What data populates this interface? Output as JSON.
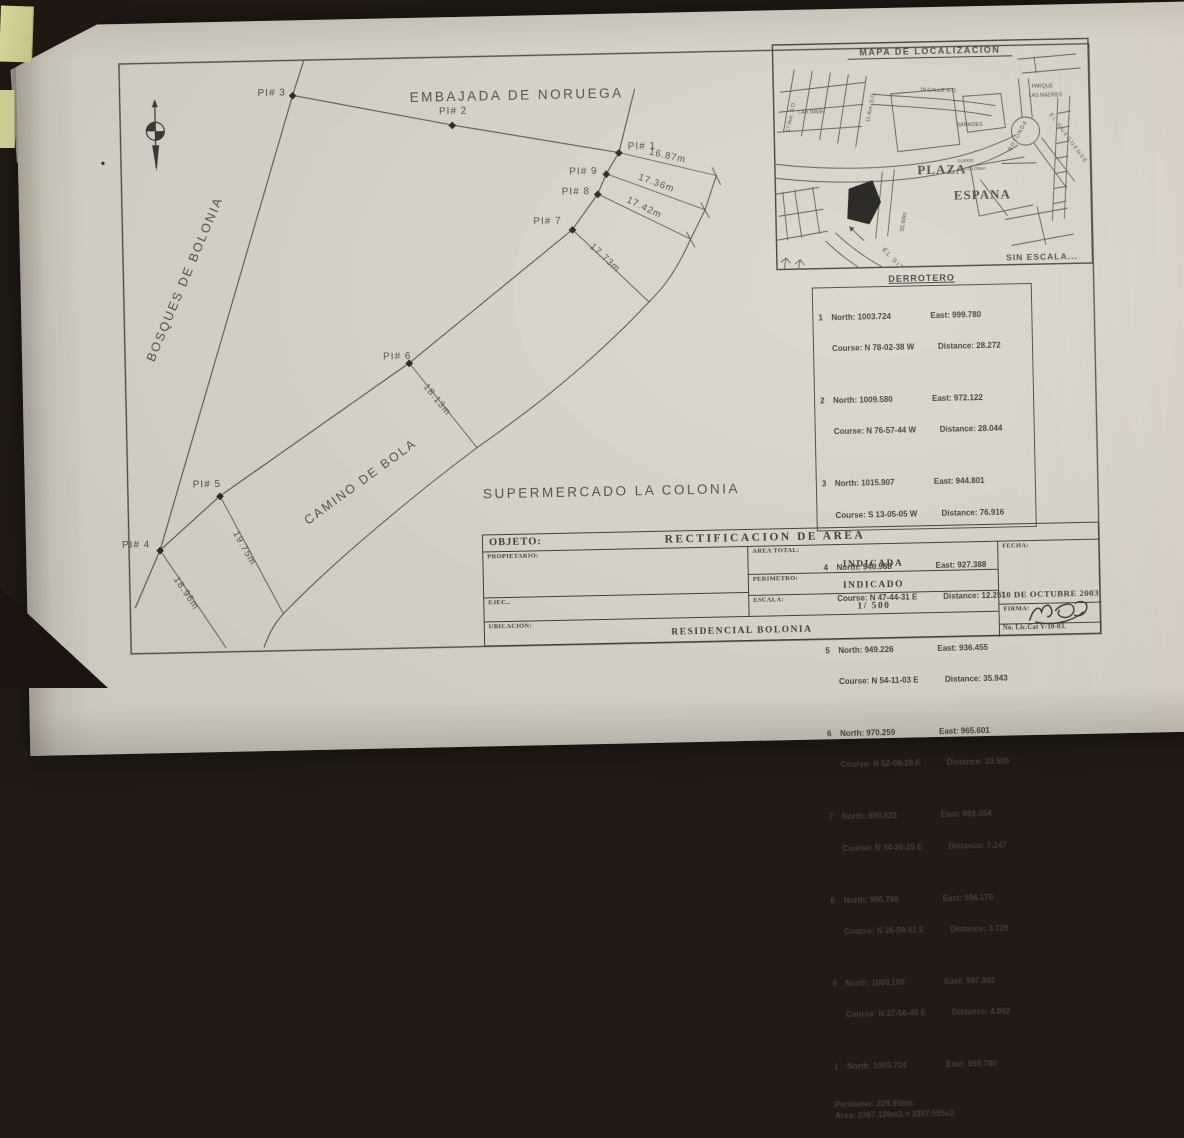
{
  "plan": {
    "embassy": "EMBAJADA DE NORUEGA",
    "bosques": "BOSQUES DE BOLONIA",
    "camino": "CAMINO DE BOLA",
    "supermercado": "SUPERMERCADO LA COLONIA",
    "pi": {
      "p1": "PI# 1",
      "p2": "PI# 2",
      "p3": "PI# 3",
      "p4": "PI# 4",
      "p5": "PI# 5",
      "p6": "PI# 6",
      "p7": "PI# 7",
      "p8": "PI# 8",
      "p9": "PI# 9"
    },
    "dims": {
      "d1": "16.87m",
      "d9": "17.36m",
      "d8": "17.42m",
      "d7": "17.73m",
      "d6": "18.13m",
      "d5": "19.75m",
      "d4": "18.96m"
    }
  },
  "map": {
    "title": "MAPA DE LOCALIZACION",
    "no_scale": "SIN ESCALA...",
    "labels": {
      "ave17": "17 Ave. S.O.",
      "carwash": "CAR WASH",
      "ave11": "11 Ave. S.O.",
      "calle18": "18 CALLE S.O.",
      "banades": "BANADES",
      "parque1": "PARQUE",
      "parque2": "LAS MADRES",
      "rotonda": "ROTONDA",
      "gueguense": "EL GUEGUENSE",
      "plaza": "PLAZA",
      "espana": "ESPANA",
      "super1": "SUPER",
      "super2": "LA COLONIA",
      "dim": "55.60m",
      "sitio": "EL SITIO"
    }
  },
  "derrotero": {
    "title": "DERROTERO",
    "labels": {
      "north": "North:",
      "east": "East:",
      "course": "Course:",
      "distance": "Distance:"
    },
    "rows": [
      {
        "n": "1",
        "north": "1003.724",
        "east": "999.780",
        "course": "N 78-02-38 W",
        "distance": "28.272"
      },
      {
        "n": "2",
        "north": "1009.580",
        "east": "972.122",
        "course": "N 76-57-44 W",
        "distance": "28.044"
      },
      {
        "n": "3",
        "north": "1015.907",
        "east": "944.801",
        "course": "S 13-05-05 W",
        "distance": "76.916"
      },
      {
        "n": "4",
        "north": "940.988",
        "east": "927.388",
        "course": "N 47-44-31 E",
        "distance": "12.251"
      },
      {
        "n": "5",
        "north": "949.226",
        "east": "936.455",
        "course": "N 54-11-03 E",
        "distance": "35.943"
      },
      {
        "n": "6",
        "north": "970.259",
        "east": "965.601",
        "course": "N 52-08-28 E",
        "distance": "33.505"
      },
      {
        "n": "7",
        "north": "990.822",
        "east": "992.054",
        "course": "N 34-36-25 E",
        "distance": "7.247"
      },
      {
        "n": "8",
        "north": "996.786",
        "east": "996.170",
        "course": "N 26-59-52 E",
        "distance": "3.729"
      },
      {
        "n": "9",
        "north": "1000.109",
        "east": "997.863",
        "course": "N 27-56-45 E",
        "distance": "4.092"
      },
      {
        "n": "1",
        "north": "1003.724",
        "east": "999.780",
        "course": "",
        "distance": ""
      }
    ],
    "perimeter": "Perimeter: 229.998m.",
    "area": "Area: 2367.139m2.= 3357.585v2."
  },
  "titleblock": {
    "objeto_label": "OBJETO:",
    "objeto_value": "RECTIFICACION  DE  AREA",
    "propietario_label": "PROPIETARIO:",
    "ejec_label": "EJEC..",
    "ubicacion_label": "UBICACION:",
    "ubicacion_value": "RESIDENCIAL  BOLONIA",
    "area_total_label": "AREA  TOTAL:",
    "area_total_value": "INDICADA",
    "perimetro_label": "PERIMETRO:",
    "perimetro_value": "INDICADO",
    "escala_label": "ESCALA:",
    "escala_value": "1/  500",
    "fecha_label": "FECHA:",
    "fecha_value": "10  DE  OCTUBRE   2003",
    "firma_label": "FIRMA:",
    "lic_value": "No. Lic.Cat V-10-03."
  }
}
